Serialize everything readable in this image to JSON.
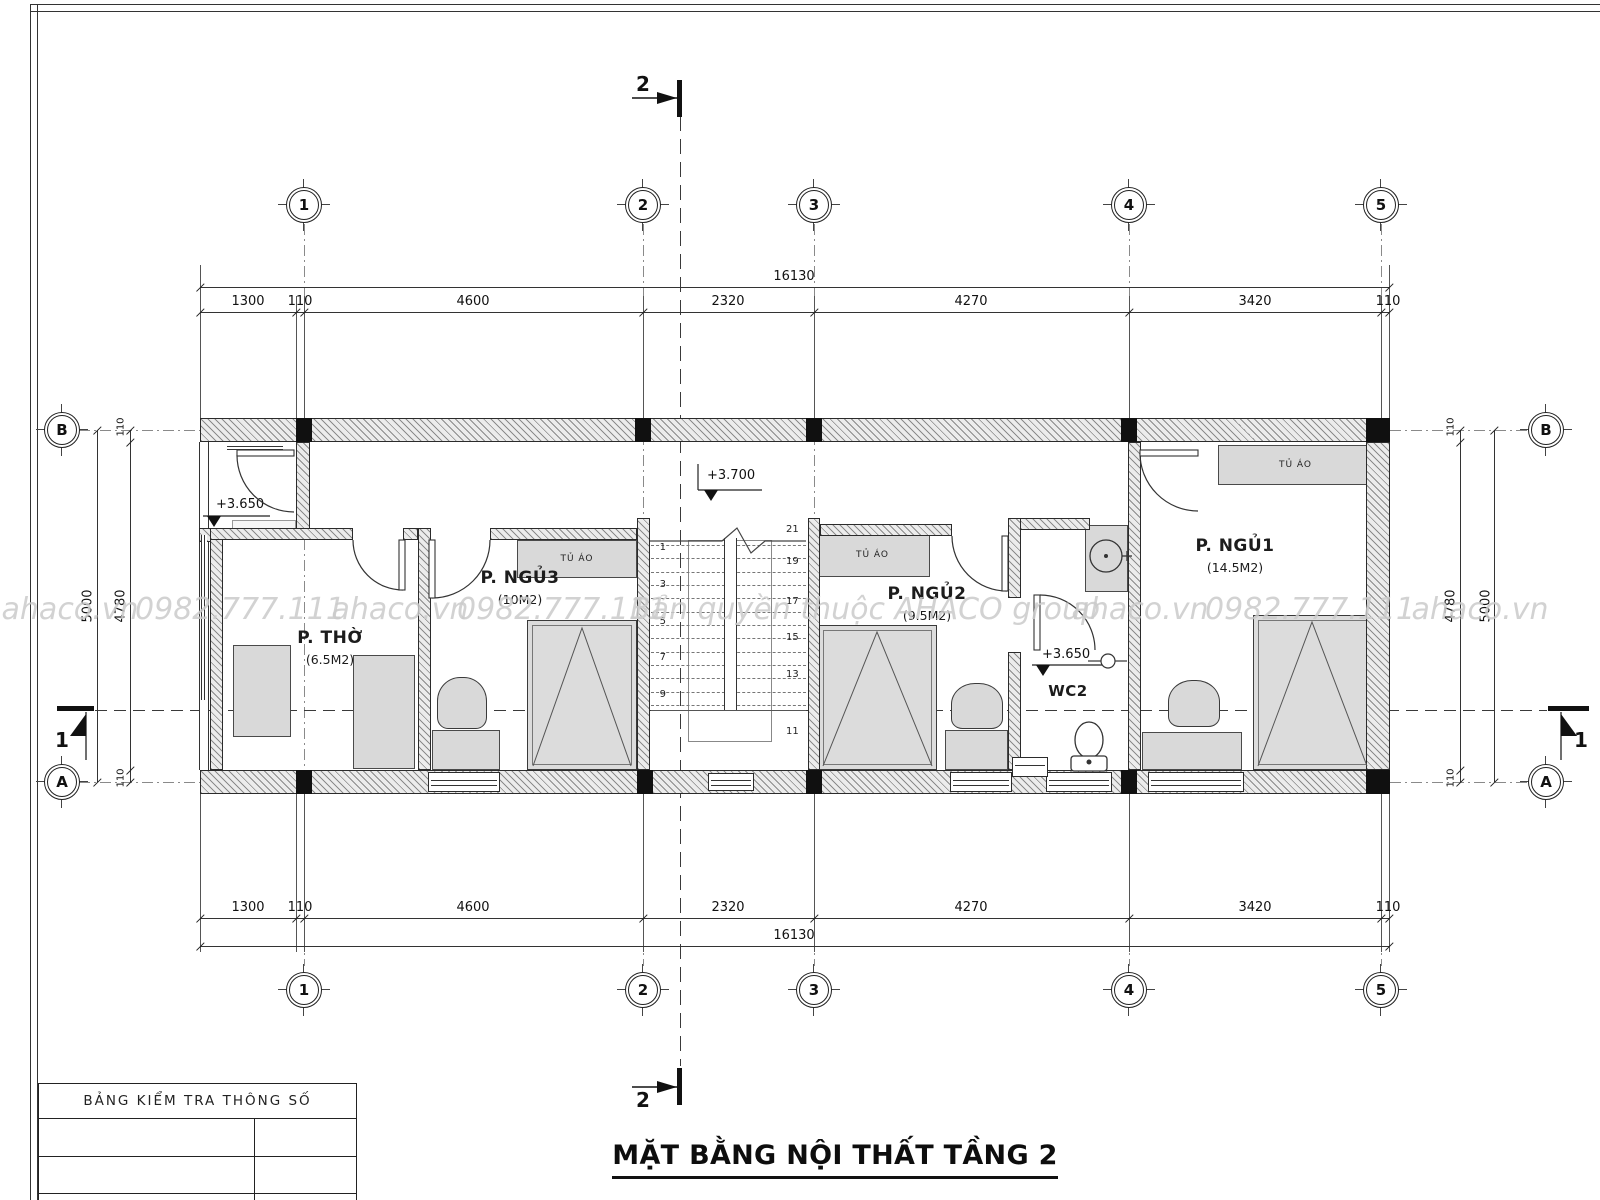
{
  "title": "MẶT BẰNG NỘI THẤT TẦNG 2",
  "grid": {
    "col_labels": [
      "1",
      "2",
      "3",
      "4",
      "5"
    ],
    "row_labels": [
      "B",
      "A"
    ]
  },
  "sections": {
    "cut1": "1",
    "cut2": "2"
  },
  "dims": {
    "overall": "16130",
    "segments": [
      "1300",
      "110",
      "4600",
      "2320",
      "4270",
      "3420",
      "110"
    ],
    "side": {
      "outer": "5000",
      "inner": "4780",
      "wall": "110"
    }
  },
  "levels": {
    "balcony": "+3.650",
    "hall": "+3.700",
    "wc": "+3.650"
  },
  "rooms": {
    "tho": {
      "name": "P. THỜ",
      "area": "(6.5M2)"
    },
    "ngu3": {
      "name": "P. NGỦ3",
      "area": "(10M2)"
    },
    "ngu2": {
      "name": "P. NGỦ2",
      "area": "(9.5M2)"
    },
    "ngu1": {
      "name": "P. NGỦ1",
      "area": "(14.5M2)"
    },
    "wc": {
      "name": "WC2"
    }
  },
  "furniture": {
    "wardrobe": "TỦ ÁO"
  },
  "stairs": {
    "left": [
      "1",
      "3",
      "5",
      "7",
      "9"
    ],
    "right": [
      "21",
      "19",
      "17",
      "15",
      "13",
      "11"
    ]
  },
  "table": {
    "header": "BẢNG KIỂM TRA THÔNG SỐ"
  },
  "watermarks": [
    "ahaco.vn",
    "0982.777.111",
    "ahaco.vn",
    "0982.777.111",
    "Bản quyền thuộc AHACO group",
    "ahaco.vn",
    "0982.777.111",
    "ahaco.vn"
  ]
}
